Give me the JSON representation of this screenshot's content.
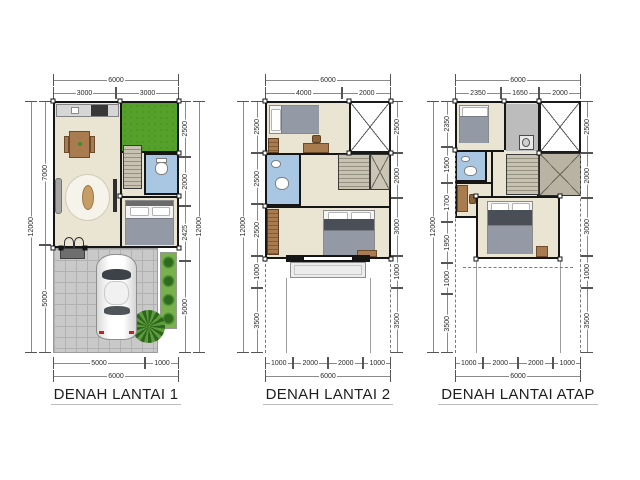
{
  "page": {
    "background": "#ffffff"
  },
  "colors": {
    "wall": "#161616",
    "floor": "#eae4d3",
    "bathroom": "#a9c7e2",
    "grass": "#55a02a",
    "paving": "#c9c9c9",
    "shrub": "#79b24c",
    "stairs": "#b0ab9a",
    "wood": "#a97c4f",
    "car_body": "#ffffff",
    "dimension_line": "#555555",
    "title_text": "#1e1e1e"
  },
  "plans": [
    {
      "id": "lantai-1",
      "title": "DENAH LANTAI 1",
      "dims": {
        "top_total": [
          "6000"
        ],
        "top": [
          "3000",
          "3000"
        ],
        "left_total": [
          "12000"
        ],
        "left": [
          "7000",
          "5000"
        ],
        "right": [
          "2500",
          "2000",
          "2425",
          "5000"
        ],
        "right_total": [
          "12000"
        ],
        "bottom": [
          "5000",
          "1000"
        ],
        "bottom_total": [
          "6000"
        ]
      }
    },
    {
      "id": "lantai-2",
      "title": "DENAH LANTAI 2",
      "dims": {
        "top_total": [
          "6000"
        ],
        "top": [
          "4000",
          "2000"
        ],
        "left_total": [
          "12000"
        ],
        "left": [
          "2500",
          "2500",
          "2500",
          "1000",
          "3500"
        ],
        "right": [
          "2500",
          "2000",
          "3000",
          "1000",
          "3500"
        ],
        "bottom": [
          "1000",
          "2000",
          "2000",
          "1000"
        ],
        "bottom_total": [
          "6000"
        ]
      }
    },
    {
      "id": "lantai-atap",
      "title": "DENAH LANTAI ATAP",
      "dims": {
        "top_total": [
          "6000"
        ],
        "top": [
          "2350",
          "1650",
          "2000"
        ],
        "left_total": [
          "12000"
        ],
        "left": [
          "2350",
          "1500",
          "1700",
          "1950",
          "1000",
          "3500"
        ],
        "right": [
          "2500",
          "2000",
          "3000",
          "1000",
          "3500"
        ],
        "bottom": [
          "1000",
          "2000",
          "2000",
          "1000"
        ],
        "bottom_total": [
          "6000"
        ]
      }
    }
  ]
}
